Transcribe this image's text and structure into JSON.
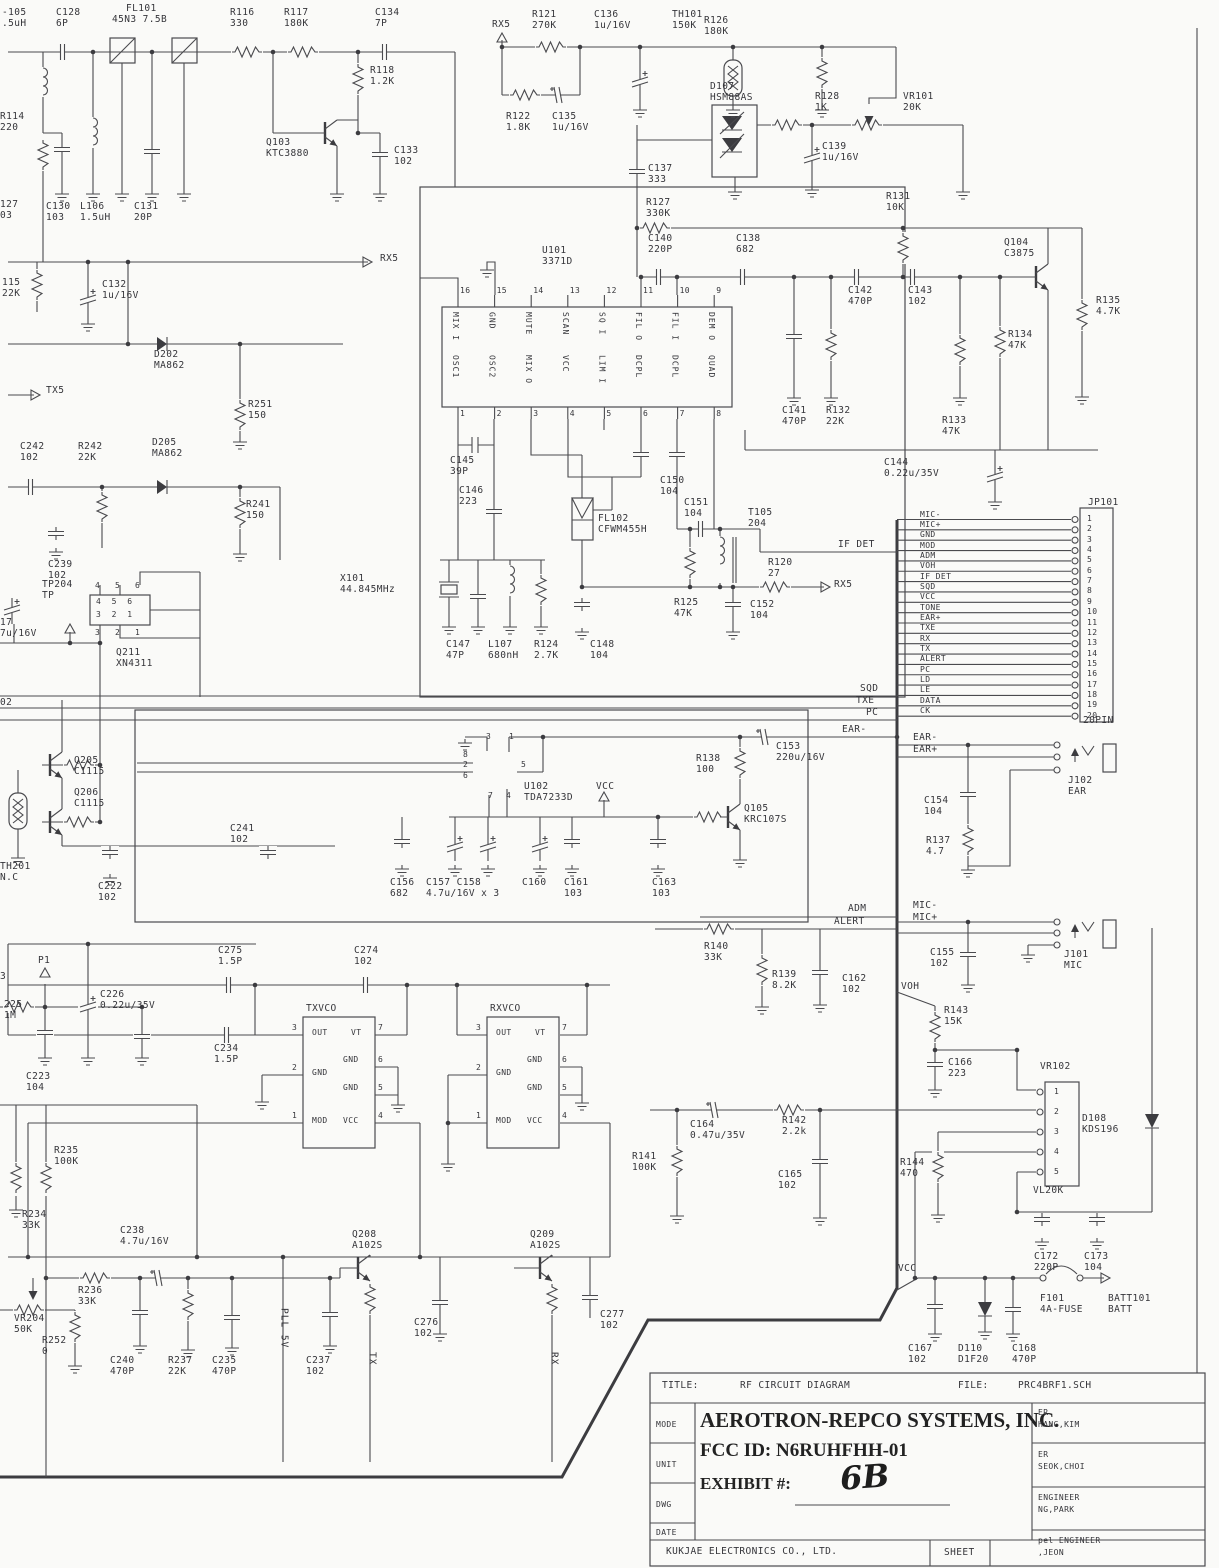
{
  "title_block": {
    "title_label": "TITLE:",
    "title": "RF CIRCUIT DIAGRAM",
    "file_label": "FILE:",
    "file": "PRC4BRF1.SCH",
    "company": "AEROTRON-REPCO SYSTEMS, INC.",
    "fcc_id": "FCC ID: N6RUHFHH-01",
    "exhibit_label": "EXHIBIT #:",
    "exhibit_value": "6B",
    "row_labels": [
      "MODE",
      "UNIT",
      "DWG",
      "DATE"
    ],
    "signoff": [
      {
        "role": "ER",
        "name": "HANG,KIM"
      },
      {
        "role": "ER",
        "name": "SEOK,CHOI"
      },
      {
        "role": "ENGINEER",
        "name": "NG,PARK"
      },
      {
        "role": "pel ENGINEER",
        "name": ",JEON"
      }
    ],
    "footer_company": "KUKJAE ELECTRONICS CO., LTD.",
    "sheet_label": "SHEET"
  },
  "jp101": {
    "ref": "JP101",
    "size_label": "20PIN",
    "pins": [
      {
        "n": "1",
        "signal": "MIC-"
      },
      {
        "n": "2",
        "signal": "MIC+"
      },
      {
        "n": "3",
        "signal": "GND"
      },
      {
        "n": "4",
        "signal": "MOD"
      },
      {
        "n": "5",
        "signal": "ADM"
      },
      {
        "n": "6",
        "signal": "VOH"
      },
      {
        "n": "7",
        "signal": "IF DET"
      },
      {
        "n": "8",
        "signal": "SQD"
      },
      {
        "n": "9",
        "signal": "VCC"
      },
      {
        "n": "10",
        "signal": "TONE"
      },
      {
        "n": "11",
        "signal": "EAR+"
      },
      {
        "n": "12",
        "signal": "TXE"
      },
      {
        "n": "13",
        "signal": "RX"
      },
      {
        "n": "14",
        "signal": "TX"
      },
      {
        "n": "15",
        "signal": "ALERT"
      },
      {
        "n": "16",
        "signal": "PC"
      },
      {
        "n": "17",
        "signal": "LD"
      },
      {
        "n": "18",
        "signal": "LE"
      },
      {
        "n": "19",
        "signal": "DATA"
      },
      {
        "n": "20",
        "signal": "CK"
      }
    ]
  },
  "u101": {
    "ref": "U101",
    "part": "3371D",
    "top_pins": [
      {
        "n": "16",
        "name": "MIX I"
      },
      {
        "n": "15",
        "name": "GND"
      },
      {
        "n": "14",
        "name": "MUTE"
      },
      {
        "n": "13",
        "name": "SCAN"
      },
      {
        "n": "12",
        "name": "SQ I"
      },
      {
        "n": "11",
        "name": "FIL O"
      },
      {
        "n": "10",
        "name": "FIL I"
      },
      {
        "n": "9",
        "name": "DEM O"
      }
    ],
    "bottom_pins": [
      {
        "n": "1",
        "name": "OSC1"
      },
      {
        "n": "2",
        "name": "OSC2"
      },
      {
        "n": "3",
        "name": "MIX O"
      },
      {
        "n": "4",
        "name": "VCC"
      },
      {
        "n": "5",
        "name": "LIM I"
      },
      {
        "n": "6",
        "name": "DCPL"
      },
      {
        "n": "7",
        "name": "DCPL"
      },
      {
        "n": "8",
        "name": "QUAD"
      }
    ]
  },
  "vr102": {
    "ref": "VR102",
    "part": "VL20K",
    "pins": [
      "1",
      "2",
      "3",
      "4",
      "5"
    ]
  },
  "vco": {
    "boxes": [
      {
        "name": "TXVCO",
        "x": 303
      },
      {
        "name": "RXVCO",
        "x": 487
      }
    ],
    "pins": [
      {
        "n": "3",
        "t": "OUT",
        "side": "l",
        "y": 1035,
        "ix": 9,
        "iy": 1028
      },
      {
        "n": "7",
        "t": "VT",
        "side": "r",
        "y": 1035,
        "ix": 48,
        "iy": 1028
      },
      {
        "n": "2",
        "t": "GND",
        "side": "l",
        "y": 1075,
        "ix": 9,
        "iy": 1068
      },
      {
        "n": "6",
        "t": "GND",
        "side": "r",
        "y": 1067,
        "ix": 40,
        "iy": 1055
      },
      {
        "n": "5",
        "t": "GND",
        "side": "r",
        "y": 1095,
        "ix": 40,
        "iy": 1083
      },
      {
        "n": "1",
        "t": "MOD",
        "side": "l",
        "y": 1123,
        "ix": 9,
        "iy": 1116
      },
      {
        "n": "4",
        "t": "VCC",
        "side": "r",
        "y": 1123,
        "ix": 40,
        "iy": 1116
      }
    ]
  },
  "labels": [
    {
      "t": "-105\n.5uH",
      "x": 2,
      "y": 8
    },
    {
      "t": "C128\n6P",
      "x": 56,
      "y": 8
    },
    {
      "t": "FL101",
      "x": 126,
      "y": 4
    },
    {
      "t": "45N3 7.5B",
      "x": 112,
      "y": 15
    },
    {
      "t": "R116\n330",
      "x": 230,
      "y": 8
    },
    {
      "t": "R117\n180K",
      "x": 284,
      "y": 8
    },
    {
      "t": "C134\n7P",
      "x": 375,
      "y": 8
    },
    {
      "t": "RX5",
      "x": 492,
      "y": 20
    },
    {
      "t": "R121\n270K",
      "x": 532,
      "y": 10
    },
    {
      "t": "C136\n1u/16V",
      "x": 594,
      "y": 10
    },
    {
      "t": "TH101\n150K",
      "x": 672,
      "y": 10
    },
    {
      "t": "R126\n180K",
      "x": 704,
      "y": 16
    },
    {
      "t": "R118\n1.2K",
      "x": 370,
      "y": 66
    },
    {
      "t": "D107\nHSM88AS",
      "x": 710,
      "y": 82
    },
    {
      "t": "R128\n1K",
      "x": 815,
      "y": 92
    },
    {
      "t": "VR101\n20K",
      "x": 903,
      "y": 92
    },
    {
      "t": "R122\n1.8K",
      "x": 506,
      "y": 112
    },
    {
      "t": "C135\n1u/16V",
      "x": 552,
      "y": 112
    },
    {
      "t": "Q103\nKTC3880",
      "x": 266,
      "y": 138
    },
    {
      "t": "C133\n102",
      "x": 394,
      "y": 146
    },
    {
      "t": "C139\n1u/16V",
      "x": 822,
      "y": 142
    },
    {
      "t": "C137\n333",
      "x": 648,
      "y": 164
    },
    {
      "t": "R114\n220",
      "x": 0,
      "y": 112
    },
    {
      "t": "R127\n330K",
      "x": 646,
      "y": 198
    },
    {
      "t": "R131\n10K",
      "x": 886,
      "y": 192
    },
    {
      "t": "C130\n103",
      "x": 46,
      "y": 202
    },
    {
      "t": "L106\n1.5uH",
      "x": 80,
      "y": 202
    },
    {
      "t": "C131\n20P",
      "x": 134,
      "y": 202
    },
    {
      "t": "127\n03",
      "x": 0,
      "y": 200
    },
    {
      "t": "C140\n220P",
      "x": 648,
      "y": 234
    },
    {
      "t": "C138\n682",
      "x": 736,
      "y": 234
    },
    {
      "t": "Q104\nC3875",
      "x": 1004,
      "y": 238
    },
    {
      "t": "U101\n3371D",
      "x": 542,
      "y": 246
    },
    {
      "t": "RX5",
      "x": 380,
      "y": 254
    },
    {
      "t": "115\n22K",
      "x": 2,
      "y": 278
    },
    {
      "t": "C132\n1u/16V",
      "x": 102,
      "y": 280
    },
    {
      "t": "C142\n470P",
      "x": 848,
      "y": 286
    },
    {
      "t": "C143\n102",
      "x": 908,
      "y": 286
    },
    {
      "t": "R135\n4.7K",
      "x": 1096,
      "y": 296
    },
    {
      "t": "R134\n47K",
      "x": 1008,
      "y": 330
    },
    {
      "t": "D202\nMA862",
      "x": 154,
      "y": 350
    },
    {
      "t": "TX5",
      "x": 46,
      "y": 386
    },
    {
      "t": "R251\n150",
      "x": 248,
      "y": 400
    },
    {
      "t": "C141\n470P",
      "x": 782,
      "y": 406
    },
    {
      "t": "R132\n22K",
      "x": 826,
      "y": 406
    },
    {
      "t": "R133\n47K",
      "x": 942,
      "y": 416
    },
    {
      "t": "C242\n102",
      "x": 20,
      "y": 442
    },
    {
      "t": "R242\n22K",
      "x": 78,
      "y": 442
    },
    {
      "t": "D205\nMA862",
      "x": 152,
      "y": 438
    },
    {
      "t": "C145\n39P",
      "x": 450,
      "y": 456
    },
    {
      "t": "C144\n0.22u/35V",
      "x": 884,
      "y": 458
    },
    {
      "t": "C146\n223",
      "x": 459,
      "y": 486
    },
    {
      "t": "R241\n150",
      "x": 246,
      "y": 500
    },
    {
      "t": "C150\n104",
      "x": 660,
      "y": 476
    },
    {
      "t": "C151\n104",
      "x": 684,
      "y": 498
    },
    {
      "t": "FL102\nCFWM455H",
      "x": 598,
      "y": 514
    },
    {
      "t": "T105\n204",
      "x": 748,
      "y": 508
    },
    {
      "t": "IF DET",
      "x": 838,
      "y": 540
    },
    {
      "t": "C239\n102",
      "x": 48,
      "y": 560
    },
    {
      "t": "TP204\nTP",
      "x": 42,
      "y": 580
    },
    {
      "t": "X101\n44.845MHz",
      "x": 340,
      "y": 574
    },
    {
      "t": "R120\n27",
      "x": 768,
      "y": 558
    },
    {
      "t": "RX5",
      "x": 834,
      "y": 580
    },
    {
      "t": "R125\n47K",
      "x": 674,
      "y": 598
    },
    {
      "t": "C152\n104",
      "x": 750,
      "y": 600
    },
    {
      "t": "17\n7u/16V",
      "x": 0,
      "y": 618
    },
    {
      "t": "Q211\nXN4311",
      "x": 116,
      "y": 648
    },
    {
      "t": "C147\n47P",
      "x": 446,
      "y": 640
    },
    {
      "t": "L107\n680nH",
      "x": 488,
      "y": 640
    },
    {
      "t": "R124\n2.7K",
      "x": 534,
      "y": 640
    },
    {
      "t": "C148\n104",
      "x": 590,
      "y": 640
    },
    {
      "t": "SQD",
      "x": 860,
      "y": 684
    },
    {
      "t": "TXE",
      "x": 856,
      "y": 696
    },
    {
      "t": "PC",
      "x": 866,
      "y": 708
    },
    {
      "t": "02",
      "x": 0,
      "y": 698
    },
    {
      "t": "EAR-",
      "x": 842,
      "y": 725
    },
    {
      "t": "C153\n220u/16V",
      "x": 776,
      "y": 742
    },
    {
      "t": "EAR-",
      "x": 913,
      "y": 733
    },
    {
      "t": "EAR+",
      "x": 913,
      "y": 745
    },
    {
      "t": "Q205\nC1115",
      "x": 74,
      "y": 756
    },
    {
      "t": "R138\n100",
      "x": 696,
      "y": 754
    },
    {
      "t": "Q206\nC1115",
      "x": 74,
      "y": 788
    },
    {
      "t": "U102\nTDA7233D",
      "x": 524,
      "y": 782
    },
    {
      "t": "VCC",
      "x": 596,
      "y": 782
    },
    {
      "t": "C241\n102",
      "x": 230,
      "y": 824
    },
    {
      "t": "J102\nEAR",
      "x": 1068,
      "y": 776
    },
    {
      "t": "Q105\nKRC107S",
      "x": 744,
      "y": 804
    },
    {
      "t": "C154\n104",
      "x": 924,
      "y": 796
    },
    {
      "t": "TH201\nN.C",
      "x": 0,
      "y": 862
    },
    {
      "t": "R137\n4.7",
      "x": 926,
      "y": 836
    },
    {
      "t": "C222\n102",
      "x": 98,
      "y": 882
    },
    {
      "t": "C156\n682",
      "x": 390,
      "y": 878
    },
    {
      "t": "C157 C158\n4.7u/16V x 3",
      "x": 426,
      "y": 878
    },
    {
      "t": "C160",
      "x": 522,
      "y": 878
    },
    {
      "t": "C161\n103",
      "x": 564,
      "y": 878
    },
    {
      "t": "C163\n103",
      "x": 652,
      "y": 878
    },
    {
      "t": "ADM",
      "x": 848,
      "y": 904
    },
    {
      "t": "ALERT",
      "x": 834,
      "y": 917
    },
    {
      "t": "MIC-",
      "x": 913,
      "y": 901
    },
    {
      "t": "MIC+",
      "x": 913,
      "y": 913
    },
    {
      "t": "J101\nMIC",
      "x": 1064,
      "y": 950
    },
    {
      "t": "R140\n33K",
      "x": 704,
      "y": 942
    },
    {
      "t": "C155\n102",
      "x": 930,
      "y": 948
    },
    {
      "t": "P1",
      "x": 38,
      "y": 956
    },
    {
      "t": "C275\n1.5P",
      "x": 218,
      "y": 946
    },
    {
      "t": "C274\n102",
      "x": 354,
      "y": 946
    },
    {
      "t": "R139\n8.2K",
      "x": 772,
      "y": 970
    },
    {
      "t": "C162\n102",
      "x": 842,
      "y": 974
    },
    {
      "t": "C226\n0.22u/35V",
      "x": 100,
      "y": 990
    },
    {
      "t": "VOH",
      "x": 901,
      "y": 982
    },
    {
      "t": "3",
      "x": 0,
      "y": 972
    },
    {
      "t": "225\n1M",
      "x": 4,
      "y": 1000
    },
    {
      "t": "R143\n15K",
      "x": 944,
      "y": 1006
    },
    {
      "t": "TXVCO",
      "x": 306,
      "y": 1004
    },
    {
      "t": "RXVCO",
      "x": 490,
      "y": 1004
    },
    {
      "t": "C234\n1.5P",
      "x": 214,
      "y": 1044
    },
    {
      "t": "C166\n223",
      "x": 948,
      "y": 1058
    },
    {
      "t": "VR102",
      "x": 1040,
      "y": 1062
    },
    {
      "t": "C223\n104",
      "x": 26,
      "y": 1072
    },
    {
      "t": "D108\nKDS196",
      "x": 1082,
      "y": 1114
    },
    {
      "t": "C164\n0.47u/35V",
      "x": 690,
      "y": 1120
    },
    {
      "t": "R142\n2.2k",
      "x": 782,
      "y": 1116
    },
    {
      "t": "R235\n100K",
      "x": 54,
      "y": 1146
    },
    {
      "t": "R141\n100K",
      "x": 632,
      "y": 1152
    },
    {
      "t": "C165\n102",
      "x": 778,
      "y": 1170
    },
    {
      "t": "R144\n470",
      "x": 900,
      "y": 1158
    },
    {
      "t": "VL20K",
      "x": 1033,
      "y": 1186
    },
    {
      "t": "R234\n33K",
      "x": 22,
      "y": 1210
    },
    {
      "t": "C238\n4.7u/16V",
      "x": 120,
      "y": 1226
    },
    {
      "t": "Q208\nA102S",
      "x": 352,
      "y": 1230
    },
    {
      "t": "Q209\nA102S",
      "x": 530,
      "y": 1230
    },
    {
      "t": "C172\n220P",
      "x": 1034,
      "y": 1252
    },
    {
      "t": "C173\n104",
      "x": 1084,
      "y": 1252
    },
    {
      "t": "R236\n33K",
      "x": 78,
      "y": 1286
    },
    {
      "t": "VCC",
      "x": 898,
      "y": 1264
    },
    {
      "t": "F101\n4A-FUSE",
      "x": 1040,
      "y": 1294
    },
    {
      "t": "BATT101\nBATT",
      "x": 1108,
      "y": 1294
    },
    {
      "t": "VR204\n50K",
      "x": 14,
      "y": 1314
    },
    {
      "t": "R252\n0",
      "x": 42,
      "y": 1336
    },
    {
      "t": "C276\n102",
      "x": 414,
      "y": 1318
    },
    {
      "t": "C277\n102",
      "x": 600,
      "y": 1310
    },
    {
      "t": "C240\n470P",
      "x": 110,
      "y": 1356
    },
    {
      "t": "R237\n22K",
      "x": 168,
      "y": 1356
    },
    {
      "t": "C235\n470P",
      "x": 212,
      "y": 1356
    },
    {
      "t": "C237\n102",
      "x": 306,
      "y": 1356
    },
    {
      "t": "C167\n102",
      "x": 908,
      "y": 1344
    },
    {
      "t": "D110\nD1F20",
      "x": 958,
      "y": 1344
    },
    {
      "t": "C168\n470P",
      "x": 1012,
      "y": 1344
    },
    {
      "t": "PLL 5V",
      "x": 278,
      "y": 1308,
      "v": 1
    },
    {
      "t": "TX",
      "x": 366,
      "y": 1352,
      "v": 1
    },
    {
      "t": "RX",
      "x": 548,
      "y": 1352,
      "v": 1
    },
    {
      "t": "3",
      "x": 486,
      "y": 732,
      "s": 1
    },
    {
      "t": "1",
      "x": 509,
      "y": 732,
      "s": 1
    },
    {
      "t": "8",
      "x": 463,
      "y": 750,
      "s": 1
    },
    {
      "t": "2",
      "x": 463,
      "y": 760,
      "s": 1
    },
    {
      "t": "6",
      "x": 463,
      "y": 771,
      "s": 1
    },
    {
      "t": "5",
      "x": 521,
      "y": 760,
      "s": 1
    },
    {
      "t": "7",
      "x": 488,
      "y": 791,
      "s": 1
    },
    {
      "t": "4",
      "x": 506,
      "y": 791,
      "s": 1
    },
    {
      "t": "4  5  6",
      "x": 96,
      "y": 597,
      "s": 1
    },
    {
      "t": "3  2  1",
      "x": 96,
      "y": 610,
      "s": 1
    },
    {
      "t": "4",
      "x": 95,
      "y": 581,
      "s": 1
    },
    {
      "t": "5",
      "x": 115,
      "y": 581,
      "s": 1
    },
    {
      "t": "6",
      "x": 135,
      "y": 581,
      "s": 1
    },
    {
      "t": "3",
      "x": 95,
      "y": 628,
      "s": 1
    },
    {
      "t": "2",
      "x": 115,
      "y": 628,
      "s": 1
    },
    {
      "t": "1",
      "x": 135,
      "y": 628,
      "s": 1
    }
  ]
}
